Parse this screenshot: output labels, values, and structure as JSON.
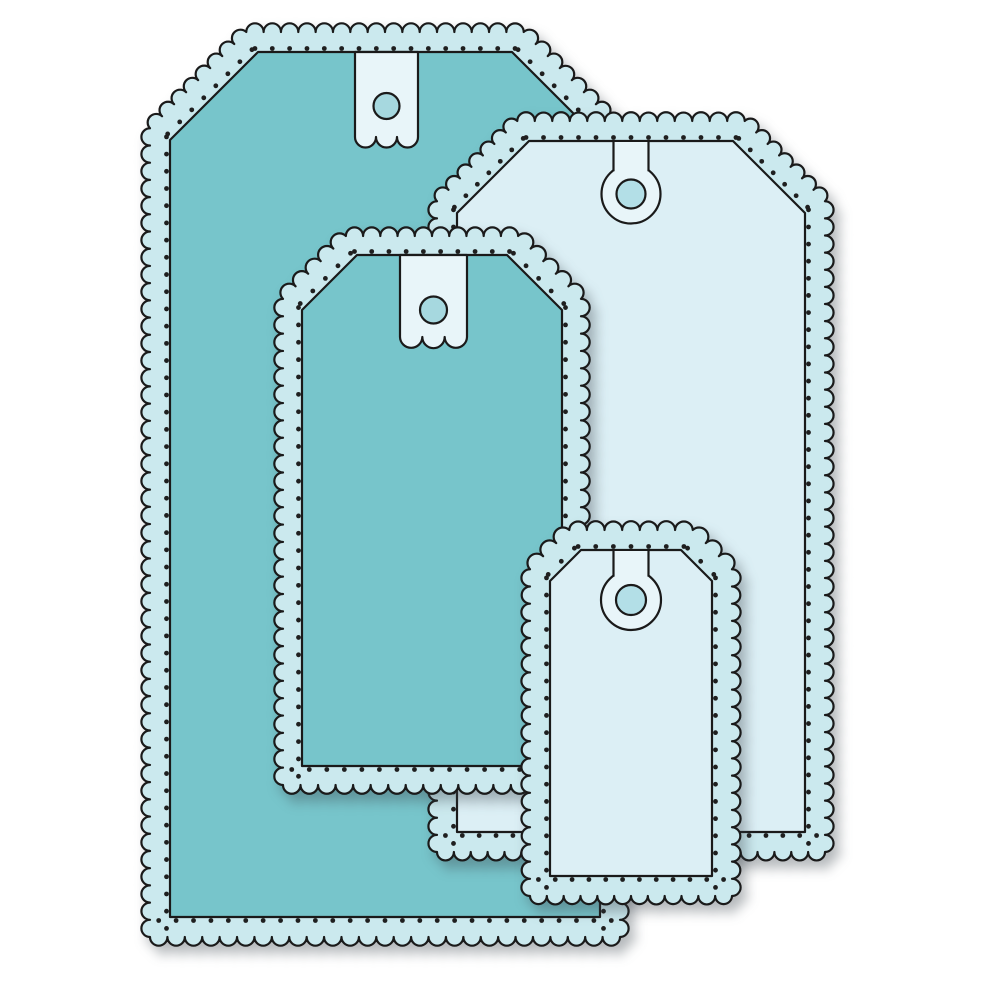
{
  "canvas": {
    "width": 1000,
    "height": 1000,
    "background": "#ffffff"
  },
  "illustration": {
    "name": "scalloped-gift-tag-die-set",
    "description_of_pixels": "four stacked scallop-edge gift tags with pierced dot borders",
    "tag_count": 4
  },
  "palette": {
    "teal_body": "#77c5cb",
    "light_body": "#dceff5",
    "scallop_band": "#cbe9ee",
    "tab_fill": "#e8f5f9",
    "hole_fill_teal_tag": "#a6d8df",
    "hole_fill_light_tag": "#b3dfe7",
    "outline": "#1a1a1a",
    "dot": "#1f1f1f",
    "shadow": "rgba(60,72,78,0.38)"
  },
  "scallop_style": {
    "bump_diameter": 17.2,
    "outline_width": 2.2,
    "dot_radius": 2.4,
    "dot_inset_from_inner_edge": 8
  },
  "tags": [
    {
      "id": "tag-large-teal",
      "role": "large scalloped tag, back left",
      "fill": "teal",
      "left": 170,
      "top": 52,
      "right": 600,
      "bottom": 917,
      "corner_cut": 88,
      "band": 20,
      "topper": {
        "type": "strip",
        "cx": 386.5,
        "width": 63,
        "base_y": 137,
        "hole_cy": 106,
        "hole_r": 13
      }
    },
    {
      "id": "tag-large-light",
      "role": "large scalloped tag, back right",
      "fill": "light",
      "left": 457,
      "top": 141,
      "right": 805,
      "bottom": 832,
      "corner_cut": 72,
      "band": 20,
      "topper": {
        "type": "keyhole",
        "cx": 631,
        "ring_cy": 194,
        "ring_r": 29.5,
        "hole_r": 14.5,
        "slot_w": 35
      }
    },
    {
      "id": "tag-medium-teal",
      "role": "medium scalloped tag, front center",
      "fill": "teal",
      "left": 302,
      "top": 255,
      "right": 562,
      "bottom": 766,
      "corner_cut": 55,
      "band": 19,
      "topper": {
        "type": "strip",
        "cx": 433.5,
        "width": 67,
        "base_y": 337,
        "hole_cy": 310,
        "hole_r": 13.5
      }
    },
    {
      "id": "tag-small-light",
      "role": "small scalloped tag, front bottom",
      "fill": "light",
      "left": 550,
      "top": 550,
      "right": 712,
      "bottom": 876,
      "corner_cut": 31,
      "band": 20,
      "topper": {
        "type": "keyhole",
        "cx": 631,
        "ring_cy": 600,
        "ring_r": 30,
        "hole_r": 15,
        "slot_w": 35
      }
    }
  ]
}
